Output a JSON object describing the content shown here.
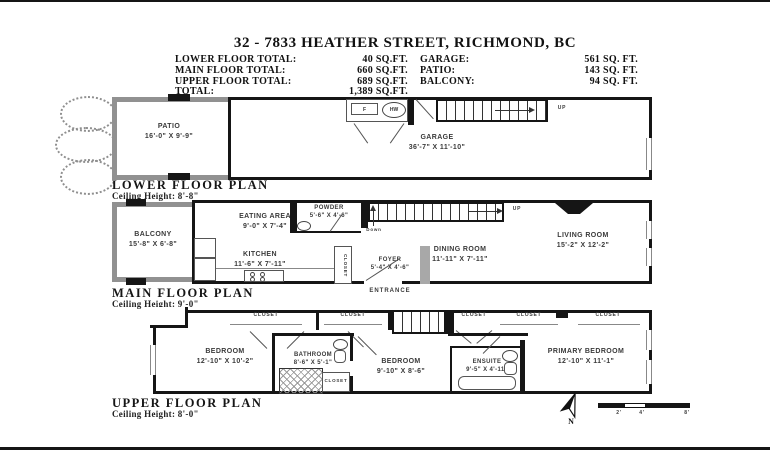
{
  "header": {
    "title": "32 - 7833 HEATHER STREET, RICHMOND, BC",
    "totals": [
      {
        "label": "LOWER FLOOR TOTAL:",
        "value": "40 SQ.FT."
      },
      {
        "label": "MAIN FLOOR TOTAL:",
        "value": "660 SQ.FT."
      },
      {
        "label": "UPPER FLOOR TOTAL:",
        "value": "689 SQ.FT."
      }
    ],
    "areas": [
      {
        "label": "GARAGE:",
        "value": "561 SQ. FT."
      },
      {
        "label": "PATIO:",
        "value": "143 SQ. FT."
      },
      {
        "label": "BALCONY:",
        "value": "94 SQ. FT."
      }
    ],
    "total": {
      "label": "TOTAL:",
      "value": "1,389 SQ.FT."
    }
  },
  "plans": {
    "lower": {
      "heading": "LOWER FLOOR PLAN",
      "ceiling": "Ceiling Height: 8'-8\"",
      "rooms": {
        "patio": {
          "name": "PATIO",
          "dims": "16'-0\" X 9'-9\""
        },
        "garage": {
          "name": "GARAGE",
          "dims": "36'-7\" X 11'-10\""
        }
      },
      "labels": {
        "furnace": "F",
        "hot_water": "HW",
        "up": "UP"
      }
    },
    "main": {
      "heading": "MAIN FLOOR PLAN",
      "ceiling": "Ceiling Height: 9'-0\"",
      "rooms": {
        "balcony": {
          "name": "BALCONY",
          "dims": "15'-8\" X 6'-8\""
        },
        "eating": {
          "name": "EATING AREA",
          "dims": "9'-0\" X 7'-4\""
        },
        "kitchen": {
          "name": "KITCHEN",
          "dims": "11'-6\" X 7'-11\""
        },
        "powder": {
          "name": "POWDER",
          "dims": "5'-6\" X 4'-6\""
        },
        "dining": {
          "name": "DINING ROOM",
          "dims": "11'-11\" X 7'-11\""
        },
        "living": {
          "name": "LIVING ROOM",
          "dims": "15'-2\" X 12'-2\""
        },
        "foyer": {
          "name": "FOYER",
          "dims": "5'-4\" X 4'-6\""
        }
      },
      "labels": {
        "closet": "CLOSET",
        "entrance": "ENTRANCE",
        "up": "UP",
        "down": "Down"
      }
    },
    "upper": {
      "heading": "UPPER FLOOR PLAN",
      "ceiling": "Ceiling Height: 8'-0\"",
      "rooms": {
        "bedroom1": {
          "name": "BEDROOM",
          "dims": "12'-10\" X 10'-2\""
        },
        "bathroom": {
          "name": "BATHROOM",
          "dims": "8'-6\" X 5'-1\""
        },
        "bedroom2": {
          "name": "BEDROOM",
          "dims": "9'-10\" X 8'-6\""
        },
        "ensuite": {
          "name": "ENSUITE",
          "dims": "9'-5\" X 4'-11\""
        },
        "primary": {
          "name": "PRIMARY BEDROOM",
          "dims": "12'-10\" X 11'-1\""
        }
      },
      "labels": {
        "closet": "CLOSET"
      }
    }
  },
  "footer": {
    "north_label": "N",
    "scale_ticks": [
      "2'",
      "4'",
      "8'"
    ]
  },
  "colors": {
    "wall": "#151515",
    "patio_wall": "#919191",
    "text": "#3a3a3a"
  }
}
